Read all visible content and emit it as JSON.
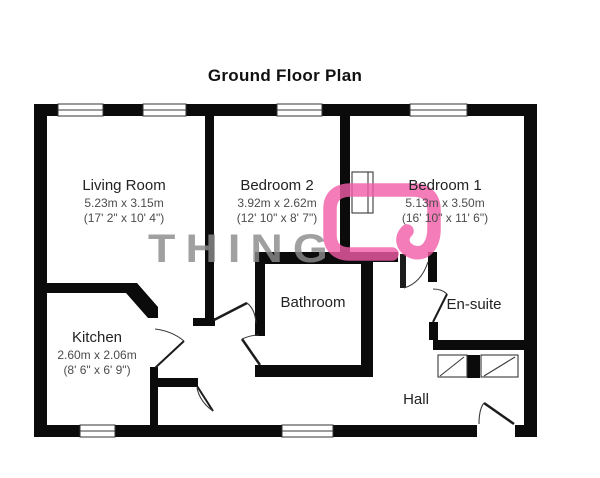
{
  "title": "Ground Floor Plan",
  "watermark": {
    "text": "THING",
    "logo_color": "#f25ca8",
    "text_color": "#8c8c8c"
  },
  "colors": {
    "wall": "#0b0b0b",
    "thin_line": "#3a3a3a",
    "accent_pink": "#f25ca8"
  },
  "rooms": [
    {
      "name": "Living Room",
      "dims_metric": "5.23m x 3.15m",
      "dims_imperial": "(17' 2\" x 10' 4\")"
    },
    {
      "name": "Bedroom 2",
      "dims_metric": "3.92m x 2.62m",
      "dims_imperial": "(12' 10\" x 8' 7\")"
    },
    {
      "name": "Bedroom 1",
      "dims_metric": "5.13m x 3.50m",
      "dims_imperial": "(16' 10\" x 11' 6\")"
    },
    {
      "name": "Kitchen",
      "dims_metric": "2.60m x 2.06m",
      "dims_imperial": "(8' 6\" x 6' 9\")"
    },
    {
      "name": "Bathroom"
    },
    {
      "name": "En-suite"
    },
    {
      "name": "Hall"
    }
  ]
}
